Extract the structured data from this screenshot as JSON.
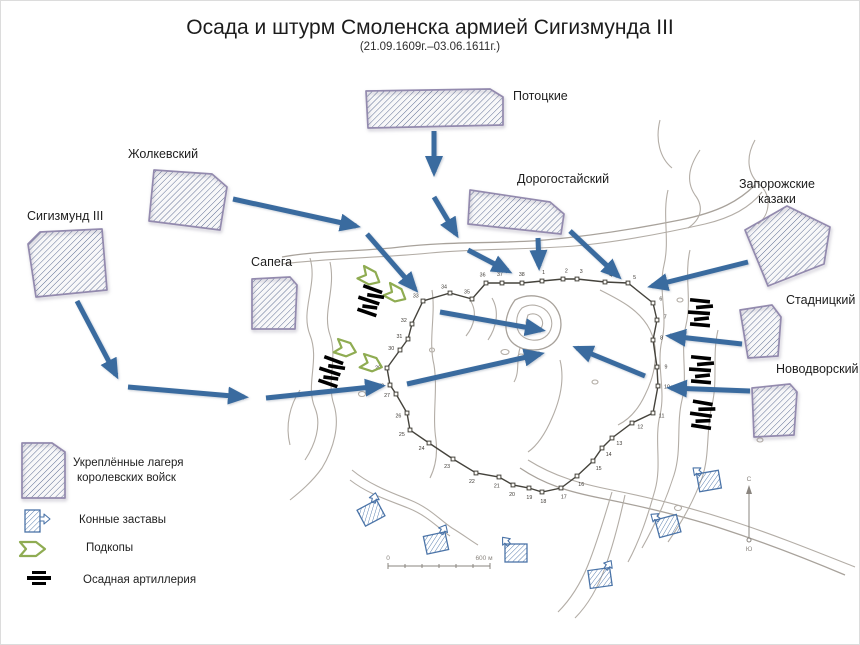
{
  "title": "Осада и штурм Смоленска армией Сигизмунда III",
  "subtitle": "(21.09.1609г.–03.06.1611г.)",
  "colors": {
    "arrow_blue": "#3a6b9f",
    "camp_border_purple": "#938aae",
    "camp_hatch_blue": "#51628a",
    "tunnel_green": "#8fac52",
    "artillery_black": "#000000",
    "outpost_blue": "#4b74a8",
    "map_contour_gray": "#b3ada6",
    "wall_dark": "#45433c"
  },
  "camps": [
    {
      "name": "sigismund-iii",
      "label": "Сигизмунд III"
    },
    {
      "name": "zholkievski",
      "label": "Жолкевский"
    },
    {
      "name": "pototski",
      "label": "Потоцкие"
    },
    {
      "name": "dorogostaiski",
      "label": "Дорогостайский"
    },
    {
      "name": "sapieha",
      "label": "Сапега"
    },
    {
      "name": "zaporozhian-cossacks",
      "label": "Запорожские казаки",
      "label_line1": "Запорожские",
      "label_line2": "казаки"
    },
    {
      "name": "stadnitski",
      "label": "Стадницкий"
    },
    {
      "name": "novodvorski",
      "label": "Новодворский"
    }
  ],
  "legend": {
    "items": [
      {
        "symbol": "fortified-camp",
        "label": "Укреплённые лагеря королевских войск",
        "label_line1": "Укреплённые лагеря",
        "label_line2": "королевских войск"
      },
      {
        "symbol": "cavalry-outpost",
        "label": "Конные заставы"
      },
      {
        "symbol": "tunnel",
        "label": "Подкопы"
      },
      {
        "symbol": "siege-artillery",
        "label": "Осадная артиллерия"
      }
    ]
  },
  "wall_towers": [
    "1",
    "2",
    "3",
    "4",
    "5",
    "6",
    "7",
    "8",
    "9",
    "10",
    "11",
    "12",
    "13",
    "14",
    "15",
    "16",
    "17",
    "18",
    "19",
    "20",
    "21",
    "22",
    "23",
    "24",
    "25",
    "26",
    "27",
    "28",
    "29",
    "30",
    "31",
    "32",
    "33",
    "34",
    "35",
    "36",
    "37",
    "38"
  ],
  "compass": {
    "north_label": "С",
    "south_label": "Ю"
  },
  "scale_bar": {
    "left_label": "0",
    "right_label": "600 м"
  }
}
